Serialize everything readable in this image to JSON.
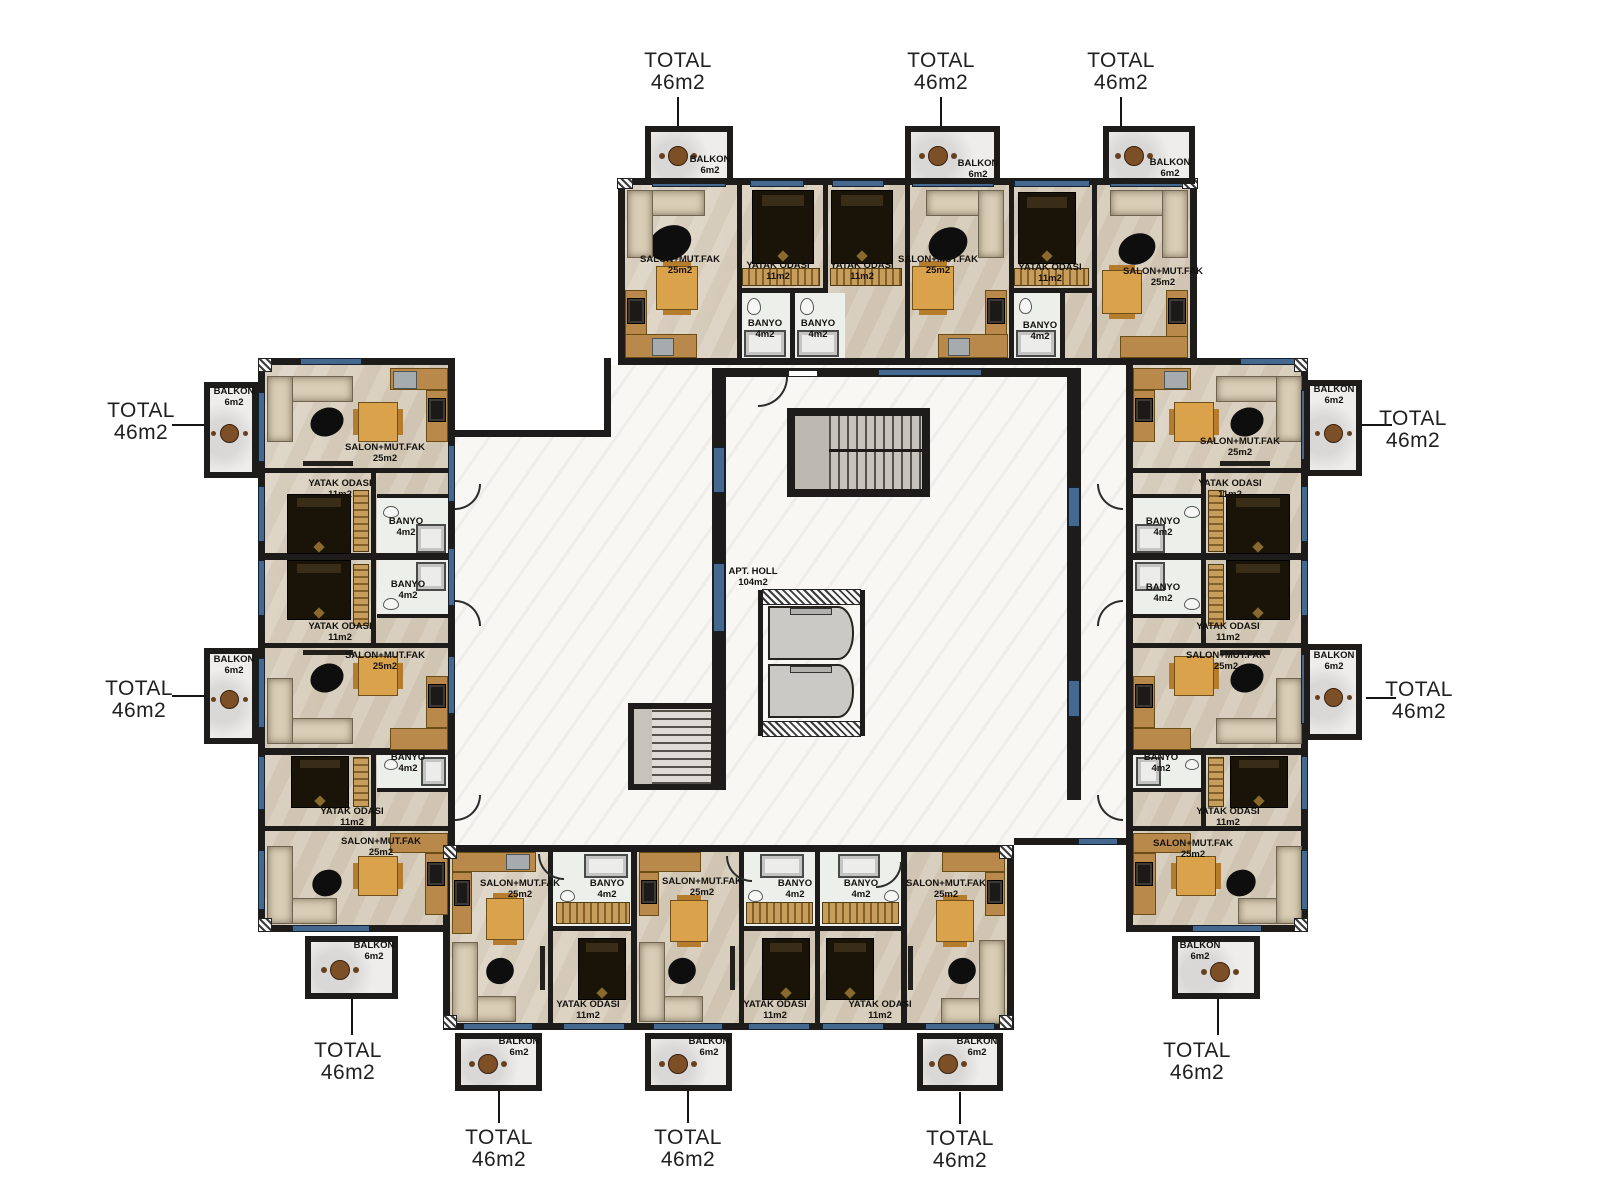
{
  "plan": {
    "unit_total": {
      "title": "TOTAL",
      "area": "46m2"
    },
    "hall": {
      "name": "APT. HOLL",
      "area": "104m2"
    },
    "rooms": {
      "living": {
        "name": "SALON+MUT.FAK",
        "area": "25m2"
      },
      "bedroom": {
        "name": "YATAK ODASI",
        "area": "11m2"
      },
      "bathroom": {
        "name": "BANYO",
        "area": "4m2"
      },
      "balcony": {
        "name": "BALKON",
        "area": "6m2"
      }
    },
    "colors": {
      "wall": "#1d1c1a",
      "window_blue": "#45688e",
      "floor_beige": "#d9cfbe",
      "corridor_marble": "#f8f7f4",
      "balcony_floor": "#eeedeb",
      "stair_gray": "#c6c3bd",
      "elevator_gray": "#cbc9c5",
      "wood": "#b9894c",
      "table_wood": "#d9a24b",
      "dark_furniture": "#191308"
    }
  }
}
